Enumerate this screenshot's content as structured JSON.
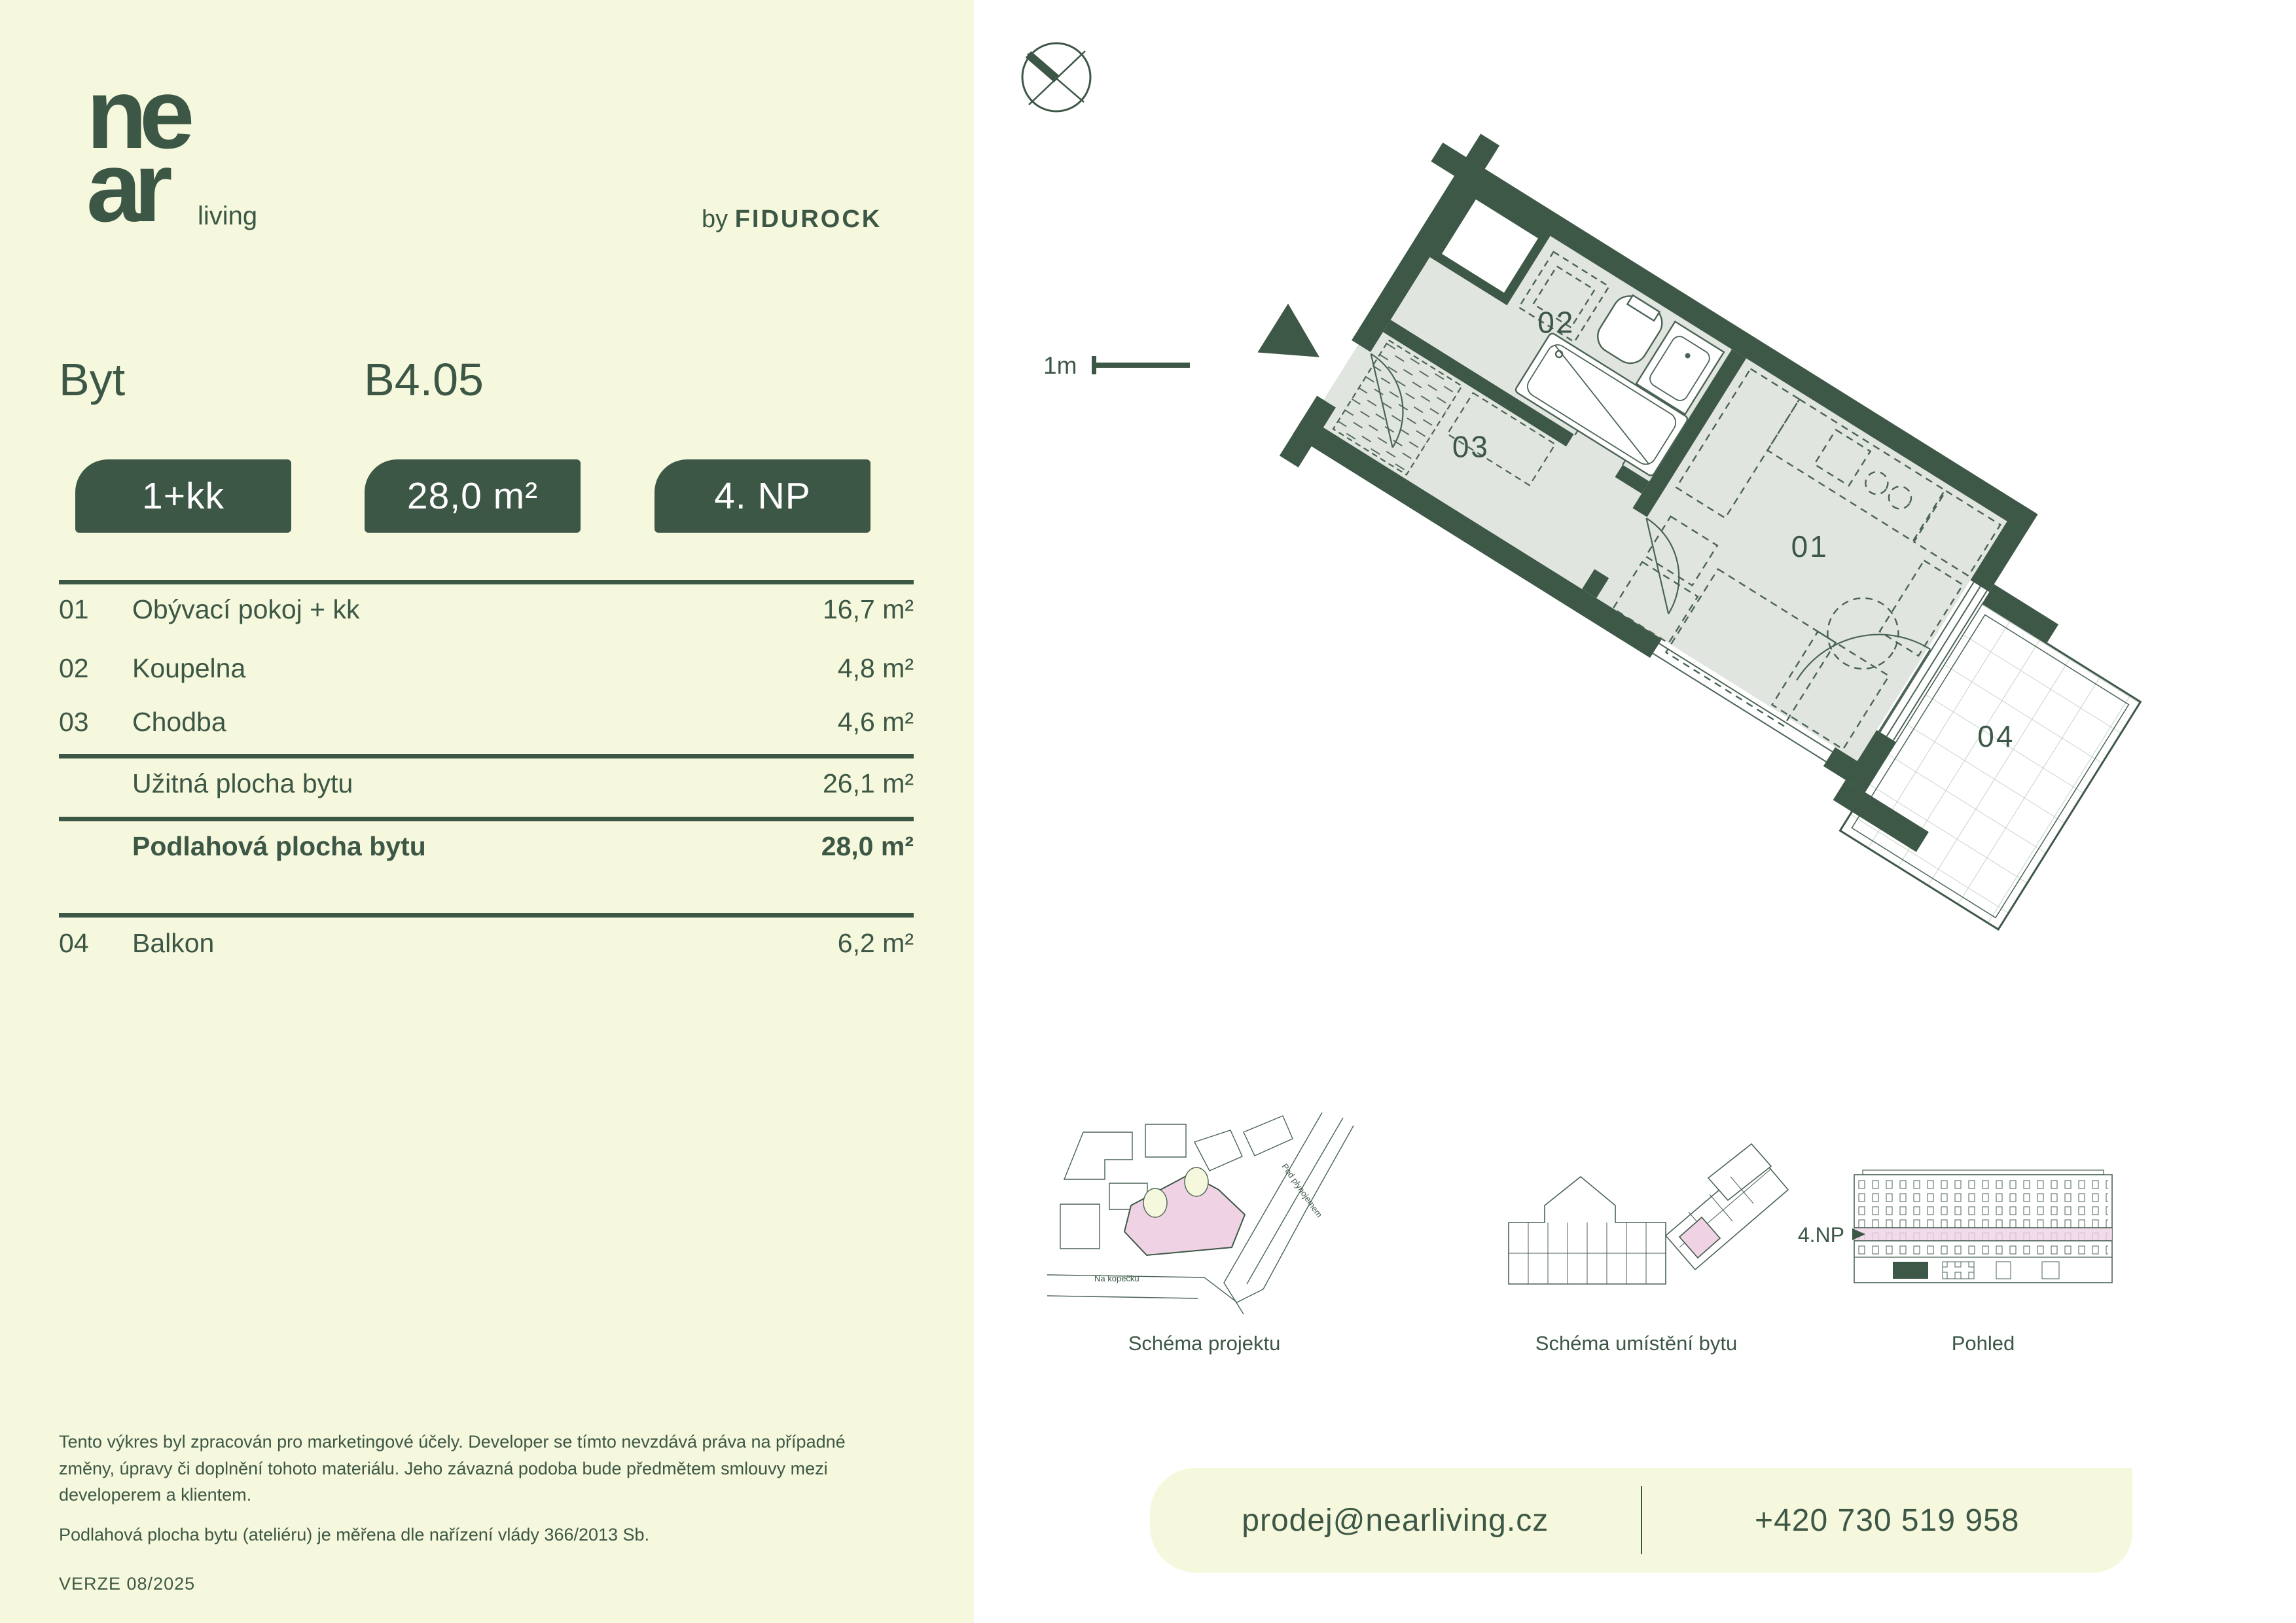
{
  "brand": {
    "logo_line1": "ne",
    "logo_line2": "ar",
    "logo_suffix": "living",
    "byline_prefix": "by",
    "byline_name": "FIDUROCK"
  },
  "header": {
    "label": "Byt",
    "unit_id": "B4.05",
    "layout_letter": "J"
  },
  "badges": [
    {
      "label": "1+kk"
    },
    {
      "label": "28,0 m²"
    },
    {
      "label": "4. NP"
    }
  ],
  "area_table": {
    "rooms": [
      {
        "no": "01",
        "name": "Obývací pokoj + kk",
        "area": "16,7 m²"
      },
      {
        "no": "02",
        "name": "Koupelna",
        "area": "4,8 m²"
      },
      {
        "no": "03",
        "name": "Chodba",
        "area": "4,6 m²"
      }
    ],
    "usable": {
      "name": "Užitná plocha bytu",
      "area": "26,1 m²"
    },
    "floor_total": {
      "name": "Podlahová plocha bytu",
      "area": "28,0 m²"
    },
    "balcony": {
      "no": "04",
      "name": "Balkon",
      "area": "6,2 m²"
    }
  },
  "plan": {
    "scale_label": "1m",
    "room_labels": {
      "r1": "01",
      "r2": "02",
      "r3": "03",
      "r4": "04"
    }
  },
  "schematics": {
    "project": {
      "label": "Schéma projektu",
      "street1": "Na kopečku",
      "street2": "Pod plynojemem"
    },
    "placement": {
      "label": "Schéma umístění bytu"
    },
    "view": {
      "label": "Pohled",
      "floor_marker": "4.NP"
    }
  },
  "footer": {
    "disclaimer": "Tento výkres byl zpracován pro marketingové účely. Developer se tímto nevzdává práva na případné změny, úpravy či doplnění tohoto materiálu. Jeho závazná podoba bude předmětem smlouvy mezi developerem a klientem.",
    "measure_note": "Podlahová plocha bytu (ateliéru) je měřena dle nařízení vlády 366/2013 Sb.",
    "version": "VERZE 08/2025"
  },
  "contact": {
    "email": "prodej@nearliving.cz",
    "phone": "+420 730 519 958"
  },
  "colors": {
    "green": "#3d5746",
    "cream": "#f5f8dc",
    "floor_gray": "#e1e5df",
    "pink": "#efd3e5",
    "white": "#ffffff"
  }
}
